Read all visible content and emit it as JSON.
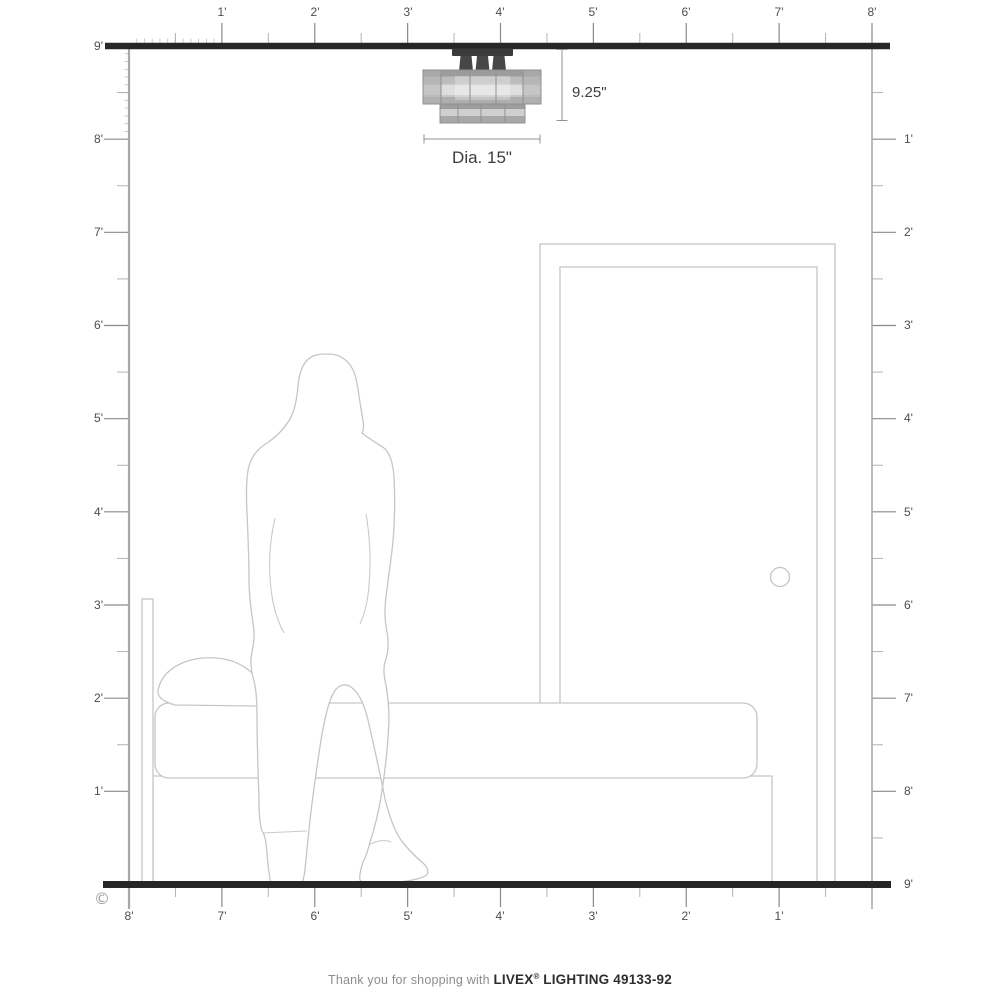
{
  "diagram": {
    "copyright": "©",
    "fixture": {
      "height_label": "9.25\"",
      "diameter_label": "Dia. 15\""
    },
    "rulers": {
      "top": {
        "labels": [
          "1'",
          "2'",
          "3'",
          "4'",
          "5'",
          "6'",
          "7'",
          "8'"
        ]
      },
      "left": {
        "labels": [
          "9'",
          "8'",
          "7'",
          "6'",
          "5'",
          "4'",
          "3'",
          "2'",
          "1'"
        ]
      },
      "right": {
        "labels": [
          "1'",
          "2'",
          "3'",
          "4'",
          "5'",
          "6'",
          "7'",
          "8'",
          "9'"
        ]
      },
      "bottom": {
        "labels": [
          "8'",
          "7'",
          "6'",
          "5'",
          "4'",
          "3'",
          "2'",
          "1'"
        ]
      }
    }
  },
  "footer": {
    "prefix": "Thank you for shopping with",
    "brand": "LIVEX",
    "registered": "®",
    "product": "LIGHTING 49133-92"
  }
}
